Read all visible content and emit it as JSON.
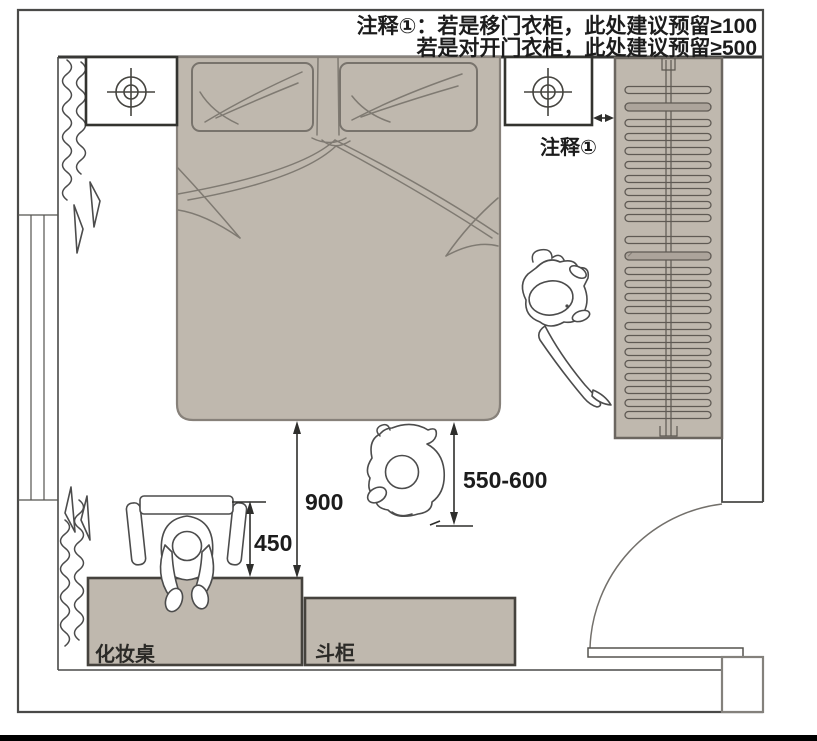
{
  "annotation": {
    "line1": "注释①：若是移门衣柜，此处建议预留≥100",
    "line2": "若是对开门衣柜，此处建议预留≥500"
  },
  "note_marker": {
    "label": "注释①"
  },
  "dimensions": {
    "bed_to_vanity": "900",
    "chair_to_vanity": "450",
    "bed_side_clearance": "550-600"
  },
  "furniture": {
    "vanity_label": "化妆桌",
    "chest_label": "斗柜"
  },
  "colors": {
    "furniture_fill": "#bfb8ae",
    "hatched_fill": "#a9a198",
    "outline": "#4a4a48",
    "text": "#1c1c1c"
  }
}
